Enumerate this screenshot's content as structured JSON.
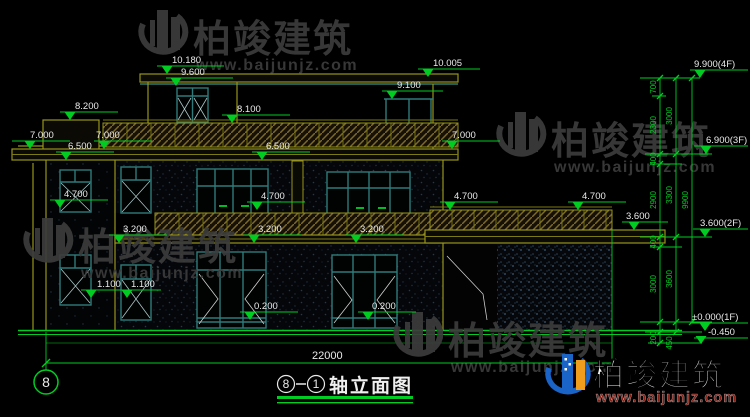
{
  "watermark": {
    "brand": "柏竣建筑",
    "url": "www.baijunjz.com"
  },
  "drawing_title": {
    "axis_from": "8",
    "axis_to": "1",
    "name": "轴立面图"
  },
  "axis_bubble": "8",
  "overall_width_dim": "22000",
  "level_marks": {
    "v10180": "10.180",
    "v9600": "9.600",
    "v10005": "10.005",
    "v9100": "9.100",
    "v8200": "8.200",
    "v8100": "8.100",
    "v7000": "7.000",
    "v6500": "6.500",
    "v4700": "4.700",
    "v3600": "3.600",
    "v3200": "3.200",
    "v1100": "1.100",
    "v0200": "0.200"
  },
  "floor_marks": {
    "f4": "9.900(4F)",
    "f3": "6.900(3F)",
    "f2": "3.600(2F)",
    "f1": "±0.000(1F)",
    "fg": "-0.450"
  },
  "dim_chain": {
    "c700": "700",
    "c2300": "2300",
    "c3000": "3000",
    "c400": "400",
    "c2900": "2900",
    "c3300": "3300",
    "c3600": "3600",
    "c200": "200",
    "c450": "450",
    "c9900": "9900"
  }
}
